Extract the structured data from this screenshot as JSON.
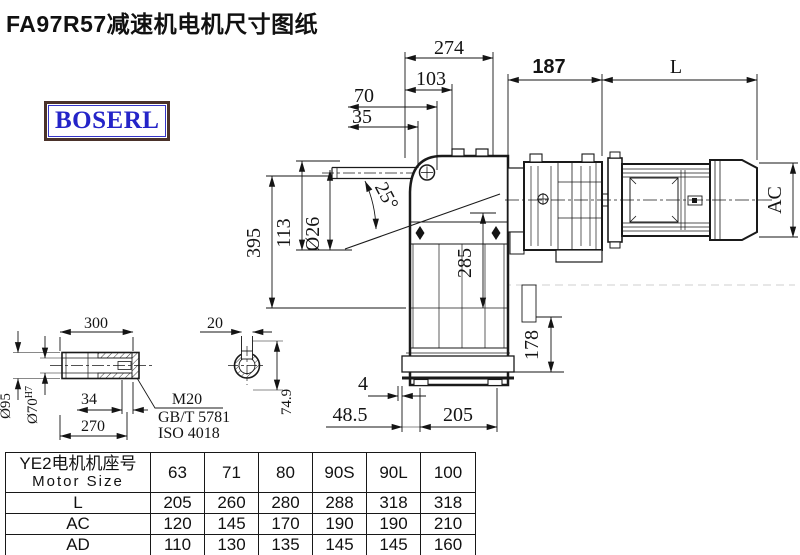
{
  "title": "FA97R57减速机电机尺寸图纸",
  "logo": {
    "text": "BOSERL"
  },
  "colors": {
    "line": "#1a1a1a",
    "logo_border": "#4a322a",
    "logo_text": "#2424c8"
  },
  "drawing": {
    "dims": {
      "d274": "274",
      "d103": "103",
      "d70": "70",
      "d35": "35",
      "d187": "187",
      "dL": "L",
      "dAC": "AC",
      "d395": "395",
      "d113": "113",
      "d26": "Ø26",
      "a25": "25°",
      "d285": "285",
      "d178": "178",
      "d4": "4",
      "d48_5": "48.5",
      "d205": "205",
      "d300": "300",
      "d20": "20",
      "d34": "34",
      "d270": "270",
      "d95": "Ø95",
      "d70h7": "Ø70",
      "d70h7_sup": "H7",
      "d74_9": "74.9",
      "thread": "M20",
      "std1": "GB/T 5781",
      "std2": "ISO 4018"
    }
  },
  "table": {
    "header": {
      "line1": "YE2电机机座号",
      "line2": "Motor Size"
    },
    "columns": [
      "63",
      "71",
      "80",
      "90S",
      "90L",
      "100"
    ],
    "rows": [
      {
        "label": "L",
        "values": [
          "205",
          "260",
          "280",
          "288",
          "318",
          "318"
        ]
      },
      {
        "label": "AC",
        "values": [
          "120",
          "145",
          "170",
          "190",
          "190",
          "210"
        ]
      },
      {
        "label": "AD",
        "values": [
          "110",
          "130",
          "135",
          "145",
          "145",
          "160"
        ]
      }
    ]
  }
}
